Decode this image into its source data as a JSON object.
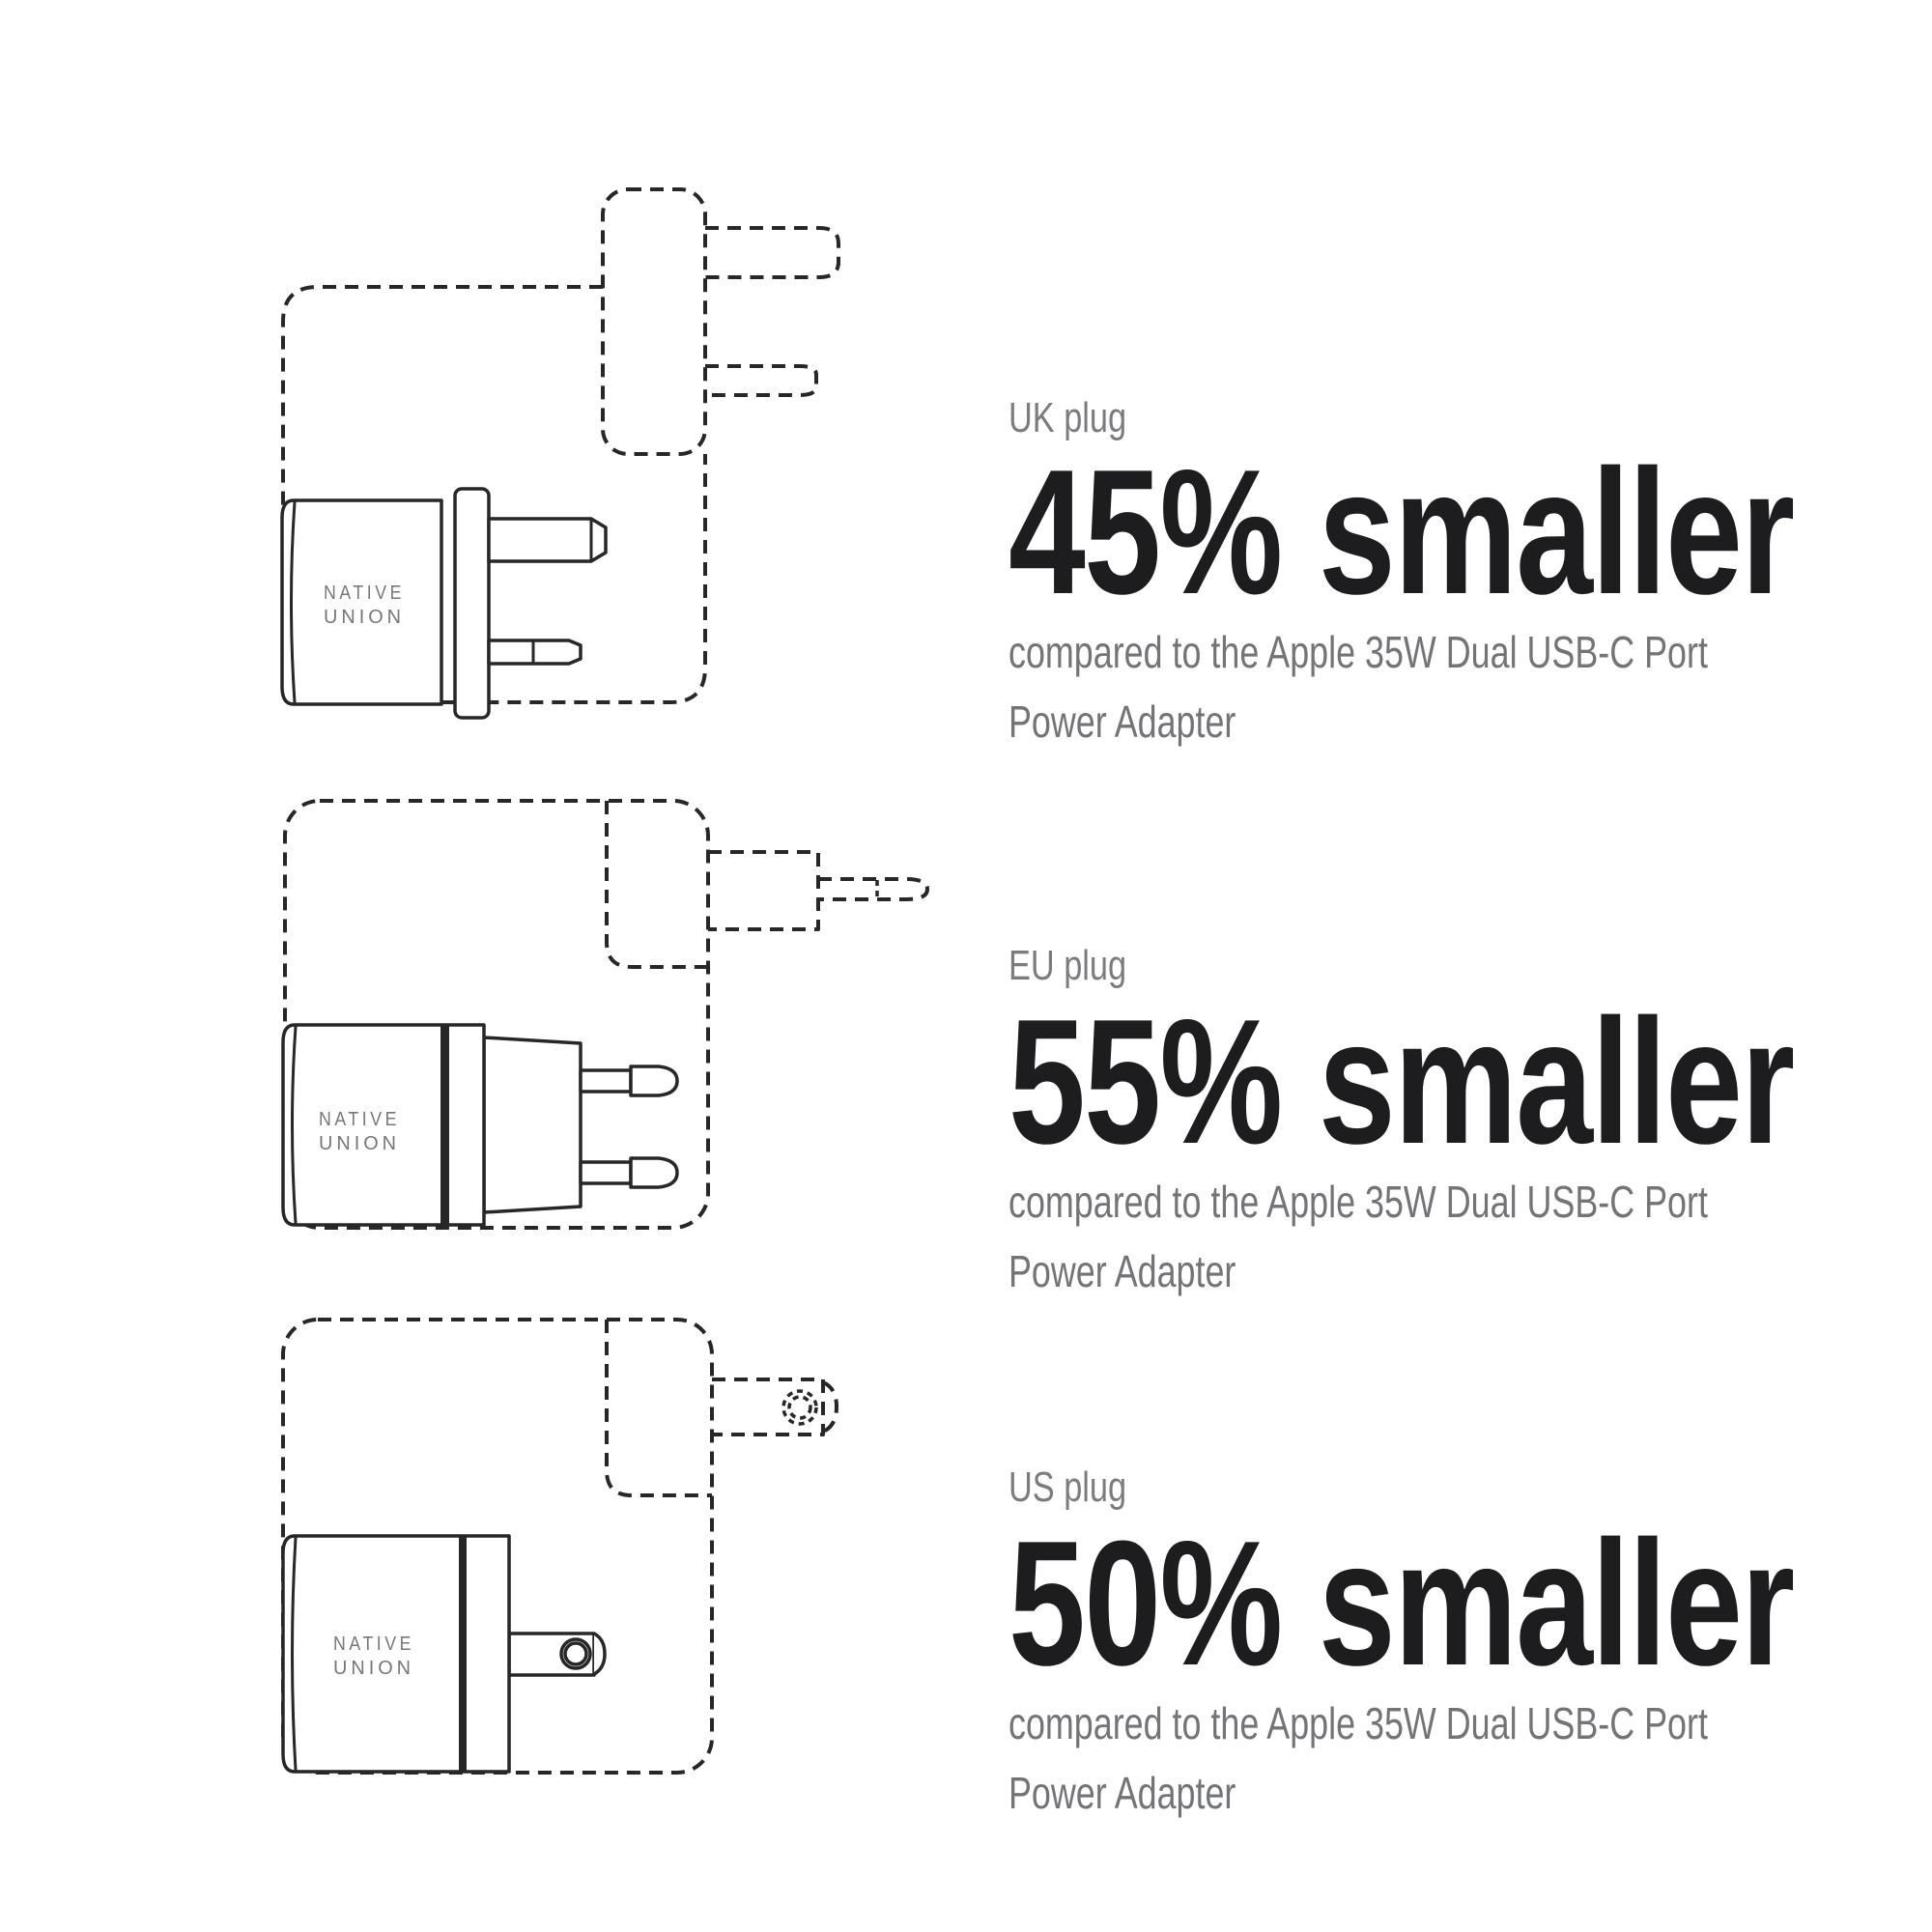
{
  "brand": {
    "line1": "NATIVE",
    "line2": "UNION"
  },
  "sections": [
    {
      "id": "uk",
      "label": "UK plug",
      "headline": "45% smaller",
      "description_lines": [
        "compared to the Apple 35W Dual USB-C Port",
        "Power Adapter"
      ]
    },
    {
      "id": "eu",
      "label": "EU plug",
      "headline": "55% smaller",
      "description_lines": [
        "compared to the Apple 35W Dual USB-C Port",
        "Power Adapter"
      ]
    },
    {
      "id": "us",
      "label": "US plug",
      "headline": "50% smaller",
      "description_lines": [
        "compared to the Apple 35W Dual USB-C Port",
        "Power Adapter"
      ]
    }
  ],
  "colors": {
    "background": "#ffffff",
    "line_ink": "#272727",
    "headline_text": "#1d1d1f",
    "gray_text": "#7b7c7f",
    "logo_gray": "#76777a"
  }
}
